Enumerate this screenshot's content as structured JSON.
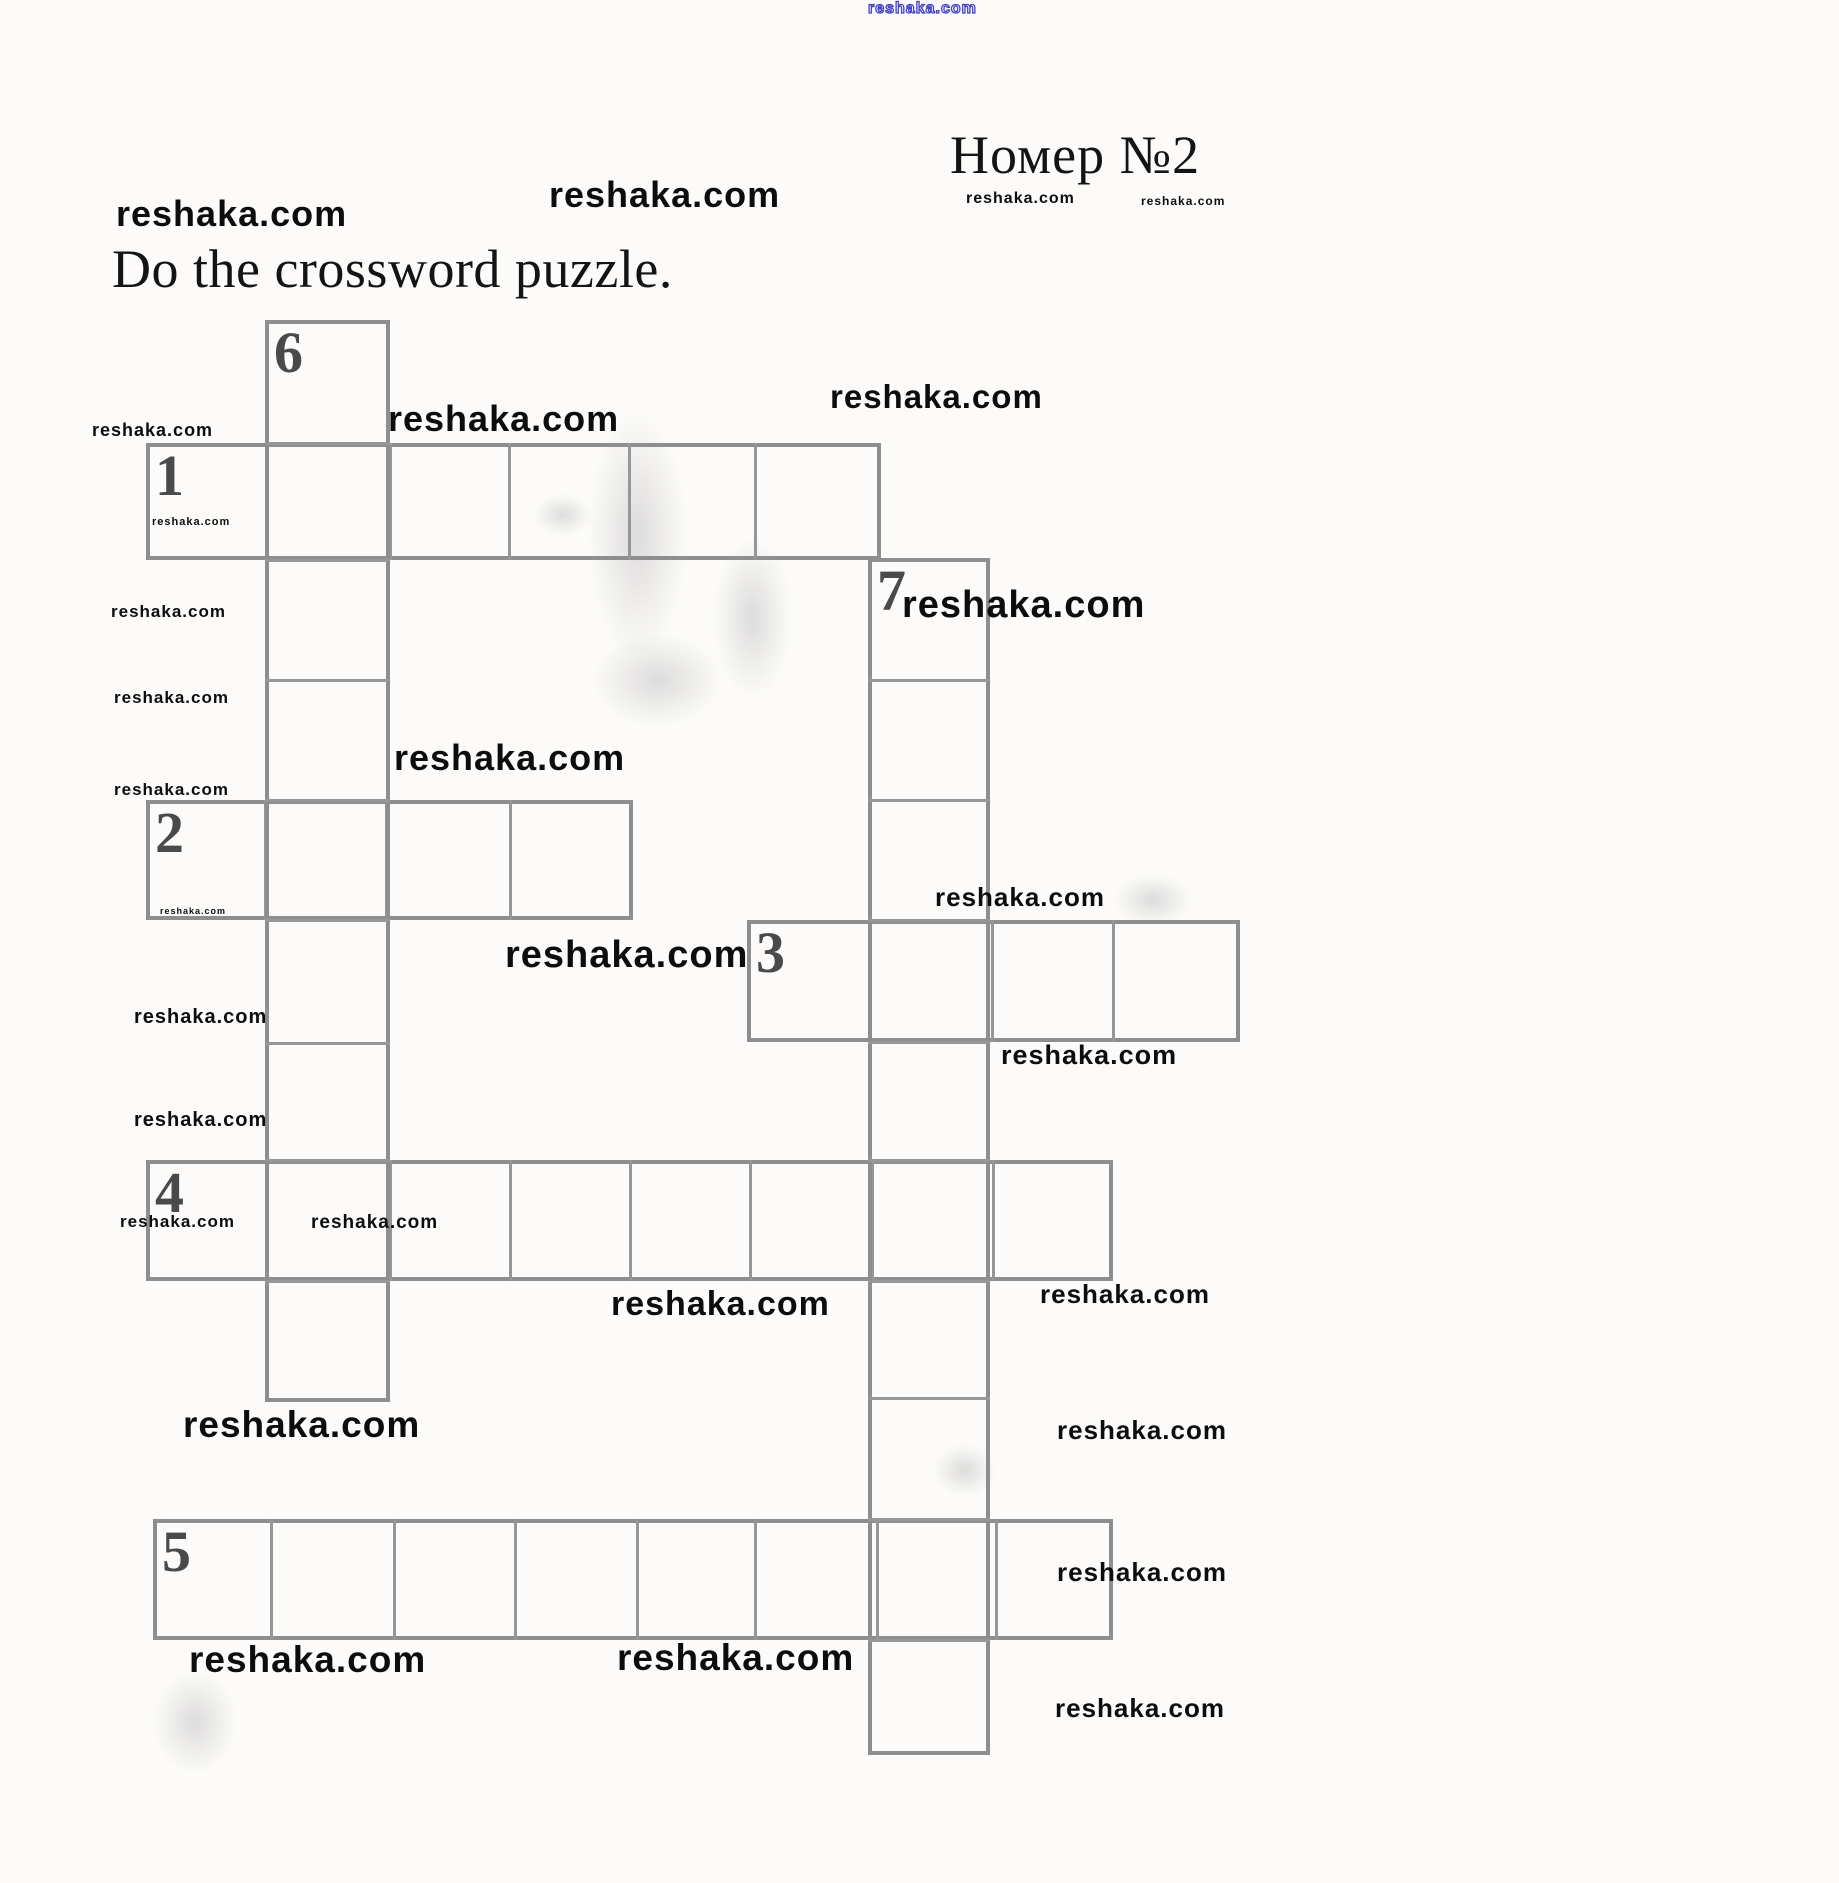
{
  "page": {
    "title": "Номер №2",
    "instruction": "Do the crossword puzzle.",
    "watermark_text": "reshaka.com",
    "colors": {
      "paper": "#fcfbf9",
      "ink": "#141414",
      "grid_line": "#8e8e8e",
      "divider": "#979797",
      "numeral": "#4a4a4a",
      "watermark": "#0d0d0d",
      "watermark_blue": "#4343c8"
    }
  },
  "crossword": {
    "clue_numbers": [
      "1",
      "2",
      "3",
      "4",
      "5",
      "6",
      "7"
    ],
    "slots": [
      {
        "number": "1",
        "dir": "across",
        "top": 443,
        "bottom": 560,
        "edges": [
          146,
          266,
          390,
          509,
          629,
          755,
          881
        ]
      },
      {
        "number": "2",
        "dir": "across",
        "top": 800,
        "bottom": 920,
        "edges": [
          146,
          265,
          386,
          510,
          633
        ]
      },
      {
        "number": "3",
        "dir": "across",
        "top": 920,
        "bottom": 1042,
        "edges": [
          747,
          870,
          992,
          1113,
          1240
        ]
      },
      {
        "number": "4",
        "dir": "across",
        "top": 1160,
        "bottom": 1281,
        "edges": [
          146,
          266,
          390,
          510,
          630,
          750,
          872,
          993,
          1113
        ]
      },
      {
        "number": "5",
        "dir": "across",
        "top": 1519,
        "bottom": 1640,
        "edges": [
          153,
          271,
          394,
          515,
          637,
          755,
          877,
          996,
          1113
        ]
      },
      {
        "number": "6",
        "dir": "down",
        "left": 265,
        "right": 390,
        "edges": [
          320,
          443,
          560,
          680,
          800,
          920,
          1043,
          1160,
          1281,
          1402
        ]
      },
      {
        "number": "7",
        "dir": "down",
        "left": 868,
        "right": 990,
        "edges": [
          558,
          680,
          800,
          920,
          1042,
          1160,
          1281,
          1398,
          1519,
          1640,
          1755
        ]
      }
    ]
  },
  "watermarks": [
    {
      "x": 868,
      "y": 1,
      "size": 16,
      "style": "blue"
    },
    {
      "x": 549,
      "y": 177,
      "size": 36,
      "style": "normal"
    },
    {
      "x": 116,
      "y": 196,
      "size": 36,
      "style": "normal"
    },
    {
      "x": 966,
      "y": 191,
      "size": 16,
      "style": "normal"
    },
    {
      "x": 1141,
      "y": 195,
      "size": 12,
      "style": "normal"
    },
    {
      "x": 388,
      "y": 401,
      "size": 36,
      "style": "normal"
    },
    {
      "x": 830,
      "y": 380,
      "size": 33,
      "style": "normal"
    },
    {
      "x": 92,
      "y": 421,
      "size": 18,
      "style": "normal"
    },
    {
      "x": 152,
      "y": 517,
      "size": 11,
      "style": "normal"
    },
    {
      "x": 902,
      "y": 586,
      "size": 38,
      "style": "normal"
    },
    {
      "x": 111,
      "y": 603,
      "size": 17,
      "style": "normal"
    },
    {
      "x": 114,
      "y": 689,
      "size": 17,
      "style": "normal"
    },
    {
      "x": 394,
      "y": 740,
      "size": 36,
      "style": "normal"
    },
    {
      "x": 114,
      "y": 781,
      "size": 17,
      "style": "normal"
    },
    {
      "x": 935,
      "y": 884,
      "size": 26,
      "style": "normal"
    },
    {
      "x": 160,
      "y": 907,
      "size": 9,
      "style": "normal"
    },
    {
      "x": 505,
      "y": 936,
      "size": 38,
      "style": "normal"
    },
    {
      "x": 134,
      "y": 1007,
      "size": 20,
      "style": "normal"
    },
    {
      "x": 1001,
      "y": 1042,
      "size": 27,
      "style": "normal"
    },
    {
      "x": 134,
      "y": 1110,
      "size": 20,
      "style": "normal"
    },
    {
      "x": 120,
      "y": 1213,
      "size": 17,
      "style": "normal"
    },
    {
      "x": 311,
      "y": 1213,
      "size": 19,
      "style": "normal"
    },
    {
      "x": 1040,
      "y": 1281,
      "size": 26,
      "style": "normal"
    },
    {
      "x": 611,
      "y": 1287,
      "size": 34,
      "style": "normal"
    },
    {
      "x": 183,
      "y": 1406,
      "size": 37,
      "style": "normal"
    },
    {
      "x": 1057,
      "y": 1417,
      "size": 26,
      "style": "normal"
    },
    {
      "x": 1057,
      "y": 1559,
      "size": 26,
      "style": "normal"
    },
    {
      "x": 189,
      "y": 1641,
      "size": 37,
      "style": "normal"
    },
    {
      "x": 617,
      "y": 1639,
      "size": 37,
      "style": "normal"
    },
    {
      "x": 1055,
      "y": 1695,
      "size": 26,
      "style": "normal"
    }
  ],
  "scan_artifacts": [
    {
      "x": 590,
      "y": 415,
      "w": 95,
      "h": 240
    },
    {
      "x": 715,
      "y": 540,
      "w": 75,
      "h": 155
    },
    {
      "x": 595,
      "y": 635,
      "w": 125,
      "h": 90
    },
    {
      "x": 535,
      "y": 495,
      "w": 55,
      "h": 40
    },
    {
      "x": 1115,
      "y": 875,
      "w": 75,
      "h": 50
    },
    {
      "x": 935,
      "y": 1445,
      "w": 60,
      "h": 50
    },
    {
      "x": 155,
      "y": 1672,
      "w": 80,
      "h": 100
    }
  ]
}
